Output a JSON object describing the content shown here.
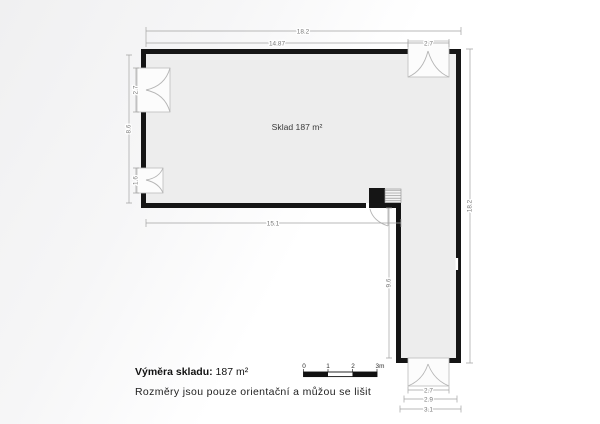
{
  "plan": {
    "room_label": "Sklad 187 m²",
    "dims": {
      "top_total": "18.2",
      "top_left": "14.87",
      "top_door": "2.7",
      "left_total": "8.6",
      "left_door_top": "2.7",
      "left_door_bottom": "1.6",
      "bottom_upper": "15.1",
      "leg_inner": "9.6",
      "right_total": "18.2",
      "bottom_door": "2.7",
      "bottom_mid": "2.9",
      "bottom_outer": "3.1"
    }
  },
  "scalebar": {
    "t0": "0",
    "t1": "1",
    "t2": "2",
    "t3": "3m"
  },
  "footer": {
    "area_label": "Výměra skladu:",
    "area_value": "187 m²",
    "disclaimer": "Rozměry jsou pouze orientační a můžou se lišit"
  },
  "colors": {
    "wall": "#151515",
    "room_fill": "#ededed",
    "scalebar_black": "#111111"
  }
}
